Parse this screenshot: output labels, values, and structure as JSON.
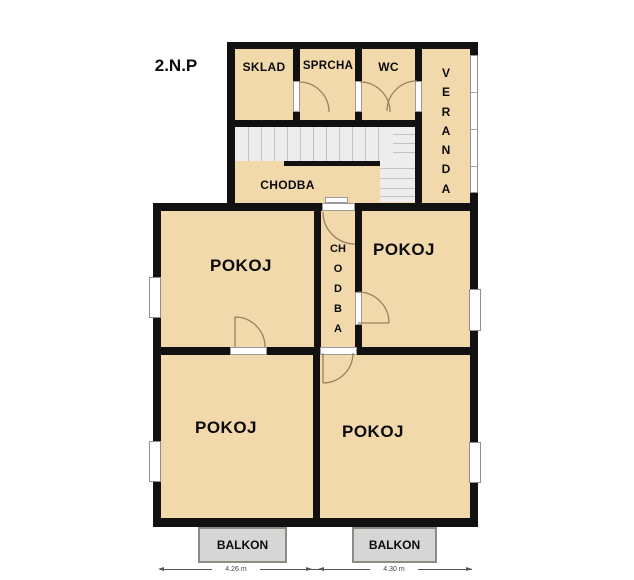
{
  "title": "2.N.P",
  "colors": {
    "wall": "#111111",
    "room": "#f2d9ac",
    "stairs": "#ededed",
    "tread": "#c3c3c3",
    "balcony": "#d6d6d6",
    "balcony-border": "#8f8a82",
    "arc": "#9a8060",
    "dim": "#555555"
  },
  "rooms": {
    "sklad": "SKLAD",
    "sprcha": "SPRCHA",
    "wc": "WC",
    "veranda": "V\nE\nR\nA\nN\nD\nA",
    "chodba_upper": "CHODBA",
    "chodba_vertical": "CH\nO\nD\nB\nA",
    "pokoj_upper_left": "POKOJ",
    "pokoj_upper_right": "POKOJ",
    "pokoj_lower_left": "POKOJ",
    "pokoj_lower_right": "POKOJ"
  },
  "balconies": {
    "left": "BALKON",
    "right": "BALKON"
  },
  "dimensions": {
    "left": "4.26 m",
    "right": "4.30 m"
  }
}
